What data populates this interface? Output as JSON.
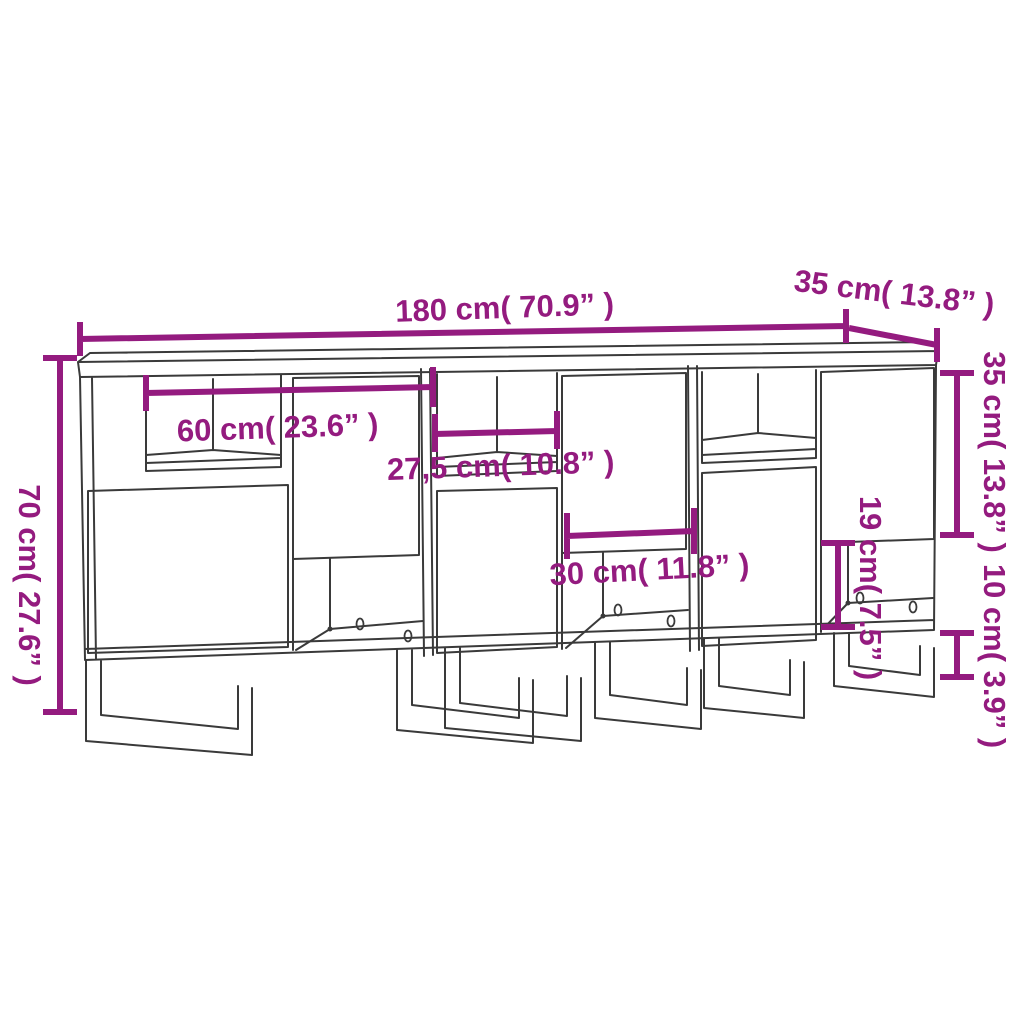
{
  "diagram": {
    "title": "Sideboard dimension diagram",
    "product": "3-piece sideboard with metal legs",
    "style": {
      "accent_color": "#941b7f",
      "line_color": "#3a3a3a",
      "background": "#ffffff"
    },
    "dimensions": {
      "overall_width": {
        "label": "180 cm( 70.9” )",
        "meaning": "total width of sideboard"
      },
      "top_depth": {
        "label": "35 cm( 13.8” )",
        "meaning": "depth of top panel"
      },
      "overall_height": {
        "label": "70 cm( 27.6” )",
        "meaning": "total height"
      },
      "unit_inner_width": {
        "label": "60 cm( 23.6” )",
        "meaning": "width of one cabinet unit"
      },
      "niche_width": {
        "label": "27,5 cm( 10.8” )",
        "meaning": "width of open niche"
      },
      "open_compartment_width": {
        "label": "30 cm( 11.8” )",
        "meaning": "width of bottom open compartment"
      },
      "open_compartment_height": {
        "label": "19 cm( 7.5” )",
        "meaning": "height of bottom open compartment"
      },
      "door_section_height": {
        "label": "35 cm( 13.8” )",
        "meaning": "height of door section"
      },
      "leg_height": {
        "label": "10 cm( 3.9” )",
        "meaning": "height of metal legs"
      }
    }
  }
}
